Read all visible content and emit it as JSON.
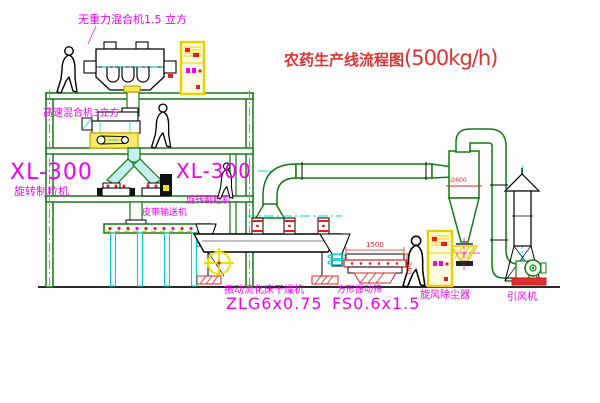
{
  "title": {
    "text_zh": "农药生产线流程图",
    "text_rate": "(500kg/h)"
  },
  "equipment_labels": {
    "gravity_mixer": "无重力混合机1.5 立方",
    "high_speed_mixer": "高速混合机3立方",
    "granulator_left_model": "XL-300",
    "granulator_left_name": "旋转制粒机",
    "granulator_mid_model": "XL-300",
    "granulator_mid_name": "旋转制粒机",
    "belt_conveyor": "皮带输送机",
    "fluid_bed_dryer_name": "振动流化床干燥机",
    "fluid_bed_dryer_model": "ZLG6x0.75",
    "vibrating_sieve_name": "方形振动筛",
    "vibrating_sieve_model": "FS0.6x1.5",
    "cyclone": "旋风除尘器",
    "induced_draft_fan": "引风机"
  },
  "dimensions": {
    "sieve_length": "1500",
    "sieve_height": "340",
    "cyclone_diameter": "∅600"
  },
  "colors": {
    "structure_green": "#127a12",
    "centerline_cyan": "#00d4d4",
    "label_magenta": "#f000f0",
    "dimension_red": "#e02020",
    "cabinet_yellow": "#e8cf00",
    "title_red": "#dd3333"
  }
}
